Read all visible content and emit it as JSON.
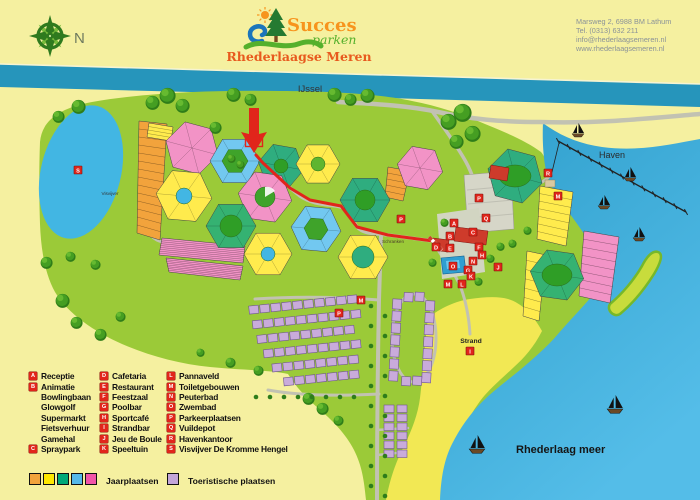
{
  "header": {
    "compass_label": "N",
    "logo": {
      "brand": "Succes",
      "brand_sub": "parken",
      "park_name": "Rhederlaagse Meren"
    },
    "address_lines": [
      "Marsweg 2, 6988 BM Lathum",
      "Tel.  (0313) 632 211",
      "info@rhederlaagsemeren.nl",
      "www.rhederlaagsemeren.nl"
    ]
  },
  "map": {
    "labels": {
      "river": "IJssel",
      "harbor": "Haven",
      "beach": "Strand",
      "lake": "Rhederlaag meer",
      "pond": "Visvijver",
      "barrier": "Schranken"
    },
    "marker_color": "#E1251B",
    "markers": [
      {
        "letter": "S"
      },
      {
        "letter": "P"
      },
      {
        "letter": "P"
      },
      {
        "letter": "P"
      },
      {
        "letter": "Q"
      },
      {
        "letter": "A"
      },
      {
        "letter": "O"
      },
      {
        "letter": "D"
      },
      {
        "letter": "B"
      },
      {
        "letter": "E"
      },
      {
        "letter": "N"
      },
      {
        "letter": "F"
      },
      {
        "letter": "G"
      },
      {
        "letter": "H"
      },
      {
        "letter": "C"
      },
      {
        "letter": "J"
      },
      {
        "letter": "K"
      },
      {
        "letter": "L"
      },
      {
        "letter": "M"
      },
      {
        "letter": "M"
      },
      {
        "letter": "M"
      },
      {
        "letter": "R"
      },
      {
        "letter": "I"
      }
    ]
  },
  "legend": {
    "columns": [
      {
        "items": [
          {
            "letter": "A",
            "label": "Receptie"
          },
          {
            "letter": "B",
            "label": "Animatie"
          },
          {
            "letter": "",
            "label": "Bowlingbaan"
          },
          {
            "letter": "",
            "label": "Glowgolf"
          },
          {
            "letter": "",
            "label": "Supermarkt"
          },
          {
            "letter": "",
            "label": "Fietsverhuur"
          },
          {
            "letter": "",
            "label": "Gamehal"
          },
          {
            "letter": "C",
            "label": "Spraypark"
          }
        ]
      },
      {
        "items": [
          {
            "letter": "D",
            "label": "Cafetaria"
          },
          {
            "letter": "E",
            "label": "Restaurant"
          },
          {
            "letter": "F",
            "label": "Feestzaal"
          },
          {
            "letter": "G",
            "label": "Poolbar"
          },
          {
            "letter": "H",
            "label": "Sportcafé"
          },
          {
            "letter": "I",
            "label": "Strandbar"
          },
          {
            "letter": "J",
            "label": "Jeu de Boule"
          },
          {
            "letter": "K",
            "label": "Speeltuin"
          }
        ]
      },
      {
        "items": [
          {
            "letter": "L",
            "label": "Pannaveld"
          },
          {
            "letter": "M",
            "label": "Toiletgebouwen"
          },
          {
            "letter": "N",
            "label": "Peuterbad"
          },
          {
            "letter": "O",
            "label": "Zwembad"
          },
          {
            "letter": "P",
            "label": "Parkeerplaatsen"
          },
          {
            "letter": "Q",
            "label": "Vuildepot"
          },
          {
            "letter": "R",
            "label": "Havenkantoor"
          },
          {
            "letter": "S",
            "label": "Visvijver De Kromme Hengel"
          }
        ]
      }
    ],
    "area_types": [
      {
        "label": "Jaarplaatsen",
        "colors": [
          "#F2A33C",
          "#FFE800",
          "#00A878",
          "#55B8E8",
          "#F155A8"
        ]
      },
      {
        "label": "Toeristische plaatsen",
        "colors": [
          "#C3A6D9"
        ]
      }
    ]
  },
  "colors": {
    "background": "#F5F0A0",
    "river": "#2695BB",
    "harbor_lake": "#3AA8D8",
    "park_green": "#9BCA38",
    "beach": "#F2E854",
    "road": "#C2C2B2",
    "route_red": "#E1251B",
    "plot_yellow": "#FFEB4D",
    "plot_pink": "#F293C6",
    "plot_blue": "#72C8F0",
    "plot_teal": "#2FAD7F",
    "plot_orange": "#F2A33C",
    "plot_lilac": "#C9ABDB",
    "logo_orange": "#F7941D",
    "logo_green": "#55B02C",
    "logo_red": "#E85A1E"
  }
}
